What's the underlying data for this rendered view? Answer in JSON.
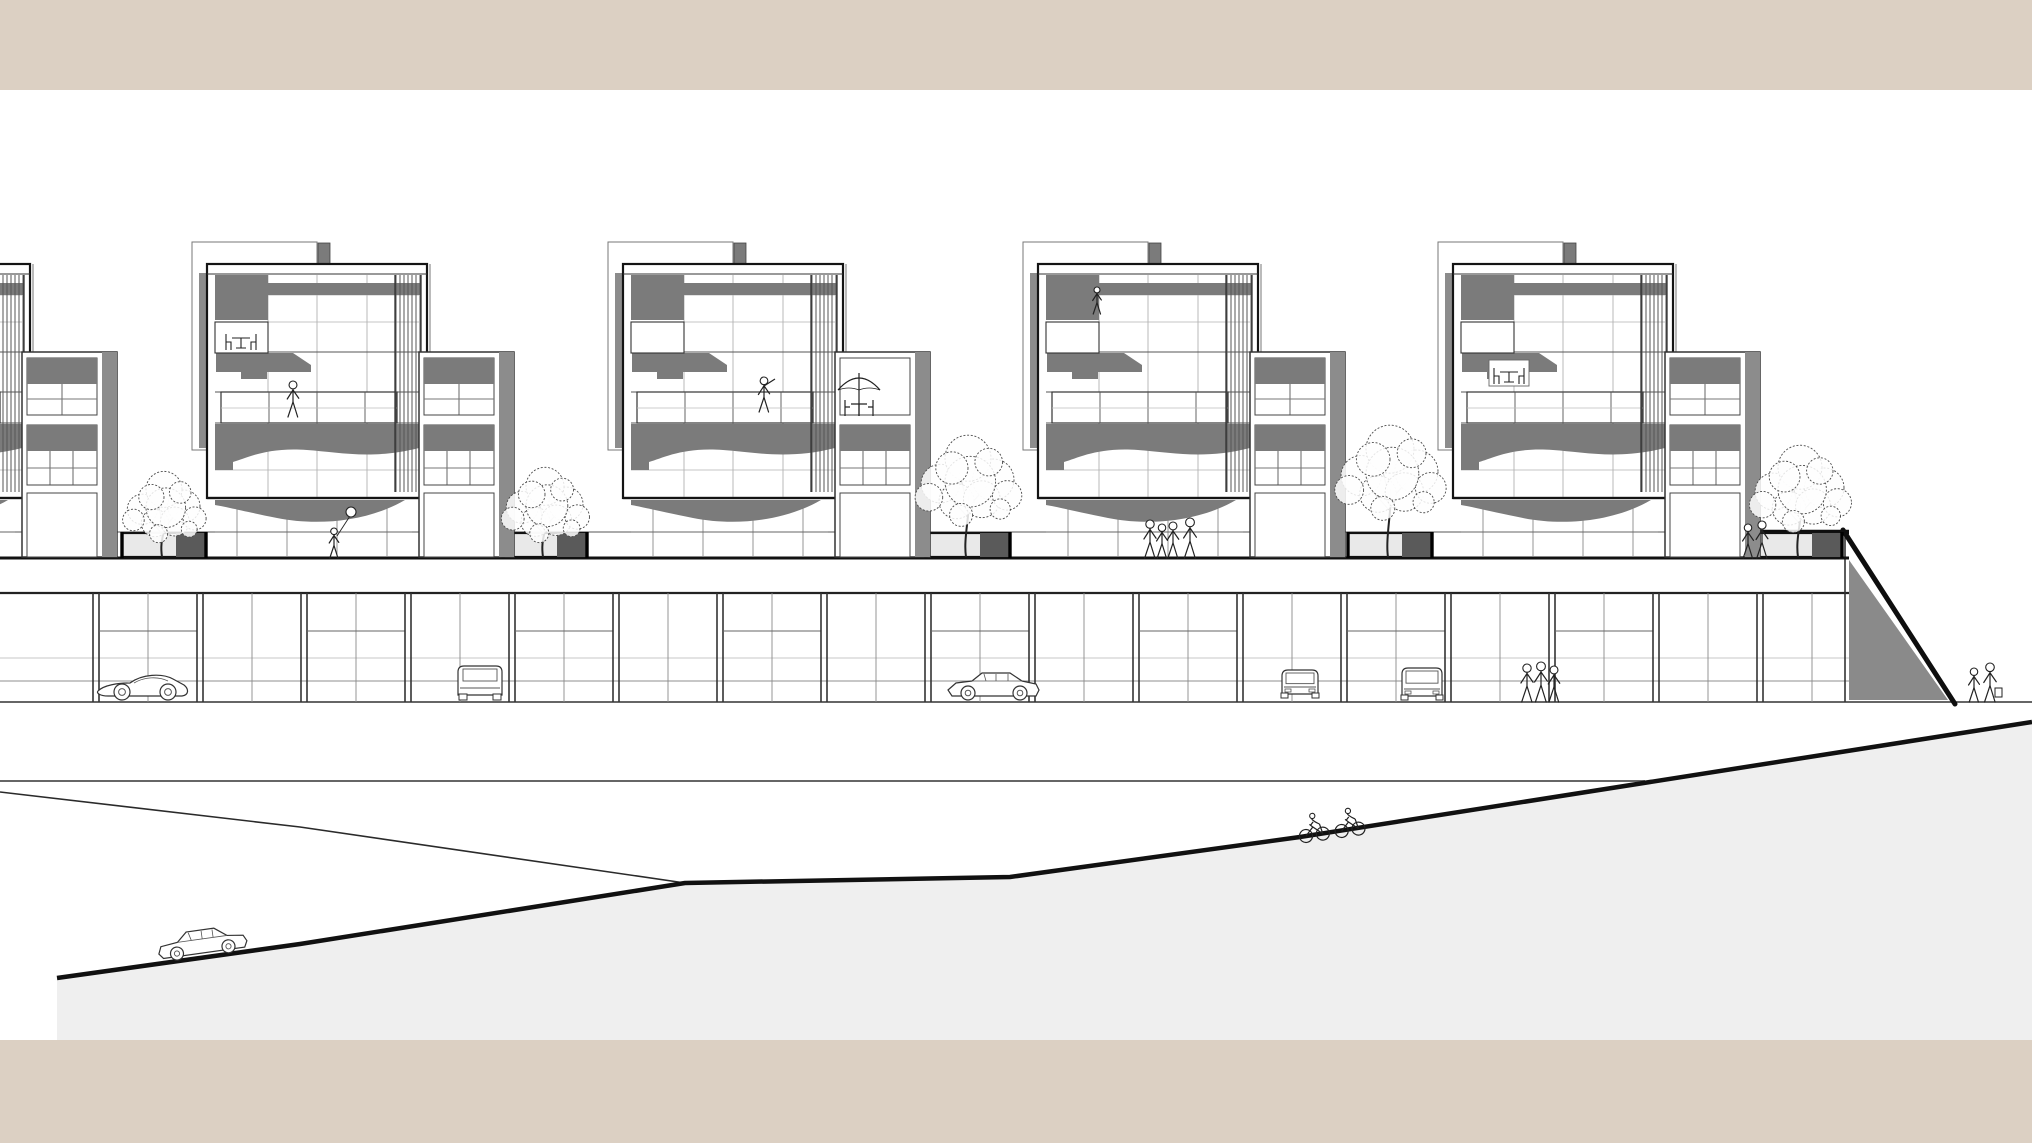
{
  "meta": {
    "drawing_type": "architectural street elevation",
    "canvas": {
      "width": 2032,
      "height": 1143
    }
  },
  "palette": {
    "paper": "#ffffff",
    "border_band": "#dcd0c3",
    "ink": "#1c1c1c",
    "line_soft": "#555555",
    "line_faint": "#a0a0a0",
    "fill_dark": "#7b7b7b",
    "pier_gray": "#8c8c8c",
    "embankment_gray": "#8a8a8a",
    "ground_gray": "#efefef",
    "planter_fill": "#e9e9e9",
    "planter_dark": "#5a5a5a"
  },
  "bands": {
    "top": {
      "x": 0,
      "y": 0,
      "w": 2032,
      "h": 90
    },
    "bottom": {
      "x": 0,
      "y": 1040,
      "w": 2032,
      "h": 103
    }
  },
  "terrain": {
    "ground_line_y": 702,
    "upper_gray_line": {
      "y": 781,
      "x1": 0,
      "x2": 1645
    },
    "thin_road": [
      [
        0,
        792
      ],
      [
        300,
        827
      ],
      [
        685,
        883
      ]
    ],
    "main_road": [
      [
        57,
        978
      ],
      [
        300,
        944
      ],
      [
        685,
        883
      ],
      [
        1010,
        877
      ],
      [
        1300,
        837
      ],
      [
        2032,
        722
      ]
    ],
    "fill_bottom_y": 1040
  },
  "deck": {
    "left": 0,
    "right": 1849,
    "surface_y": 558,
    "railing_y": 532,
    "fascia_bottom_y": 593,
    "edge_thick_from_x": 1705
  },
  "embankment": {
    "diag_top": [
      1843,
      530
    ],
    "diag_base": [
      1955,
      704
    ],
    "gray_poly": [
      [
        1849,
        560
      ],
      [
        1948,
        700
      ],
      [
        1849,
        700
      ]
    ],
    "wall_x": 1845
  },
  "podium": {
    "top_y": 593,
    "bottom_y": 702,
    "pier_start_x": 96,
    "pier_step": 104,
    "pier_end_x": 1844,
    "transom_y": 631,
    "bg_lines_y": [
      658,
      681
    ]
  },
  "buildings": [
    {
      "id": "building-left-partial",
      "x": -190,
      "wing": true,
      "umbrella": false,
      "features": []
    },
    {
      "id": "building-1",
      "x": 207,
      "wing": true,
      "umbrella": false,
      "features": [
        "dining-upper",
        "walker"
      ]
    },
    {
      "id": "building-2",
      "x": 623,
      "wing": true,
      "umbrella": true,
      "features": [
        "pointer"
      ]
    },
    {
      "id": "building-3",
      "x": 1038,
      "wing": true,
      "umbrella": false,
      "features": [
        "person-top"
      ]
    },
    {
      "id": "building-4",
      "x": 1453,
      "wing": true,
      "umbrella": false,
      "features": [
        "dining-mid"
      ]
    }
  ],
  "trees": [
    {
      "x": 164,
      "base_y": 557,
      "r": 36,
      "top_y": 472
    },
    {
      "x": 545,
      "base_y": 557,
      "r": 38,
      "top_y": 468
    },
    {
      "x": 968,
      "base_y": 557,
      "r": 46,
      "top_y": 436
    },
    {
      "x": 1390,
      "base_y": 557,
      "r": 48,
      "top_y": 426
    },
    {
      "x": 1800,
      "base_y": 557,
      "r": 44,
      "top_y": 446
    }
  ],
  "cars": [
    {
      "type": "sports-side",
      "x": 98,
      "ground": 700,
      "angle": 0
    },
    {
      "type": "suv-rear",
      "x": 458,
      "ground": 700,
      "angle": 0
    },
    {
      "type": "sedan-side",
      "x": 948,
      "ground": 700,
      "angle": 0
    },
    {
      "type": "compact-front",
      "x": 1282,
      "ground": 698,
      "angle": 0
    },
    {
      "type": "suv-front",
      "x": 1402,
      "ground": 700,
      "angle": 0
    },
    {
      "type": "sedan-slope",
      "x": 160,
      "ground": 962,
      "angle": -8
    }
  ],
  "people": [
    {
      "type": "girl-balloon",
      "x": 334,
      "y": 558
    },
    {
      "type": "group4",
      "x": 1150,
      "y": 558
    },
    {
      "type": "pair",
      "x": 1748,
      "y": 558
    },
    {
      "type": "pair-bags",
      "x": 1974,
      "y": 702
    },
    {
      "type": "trio-podium",
      "x": 1527,
      "y": 702
    },
    {
      "type": "cyclists",
      "x": 1306,
      "y": 836,
      "angle": -8
    }
  ]
}
